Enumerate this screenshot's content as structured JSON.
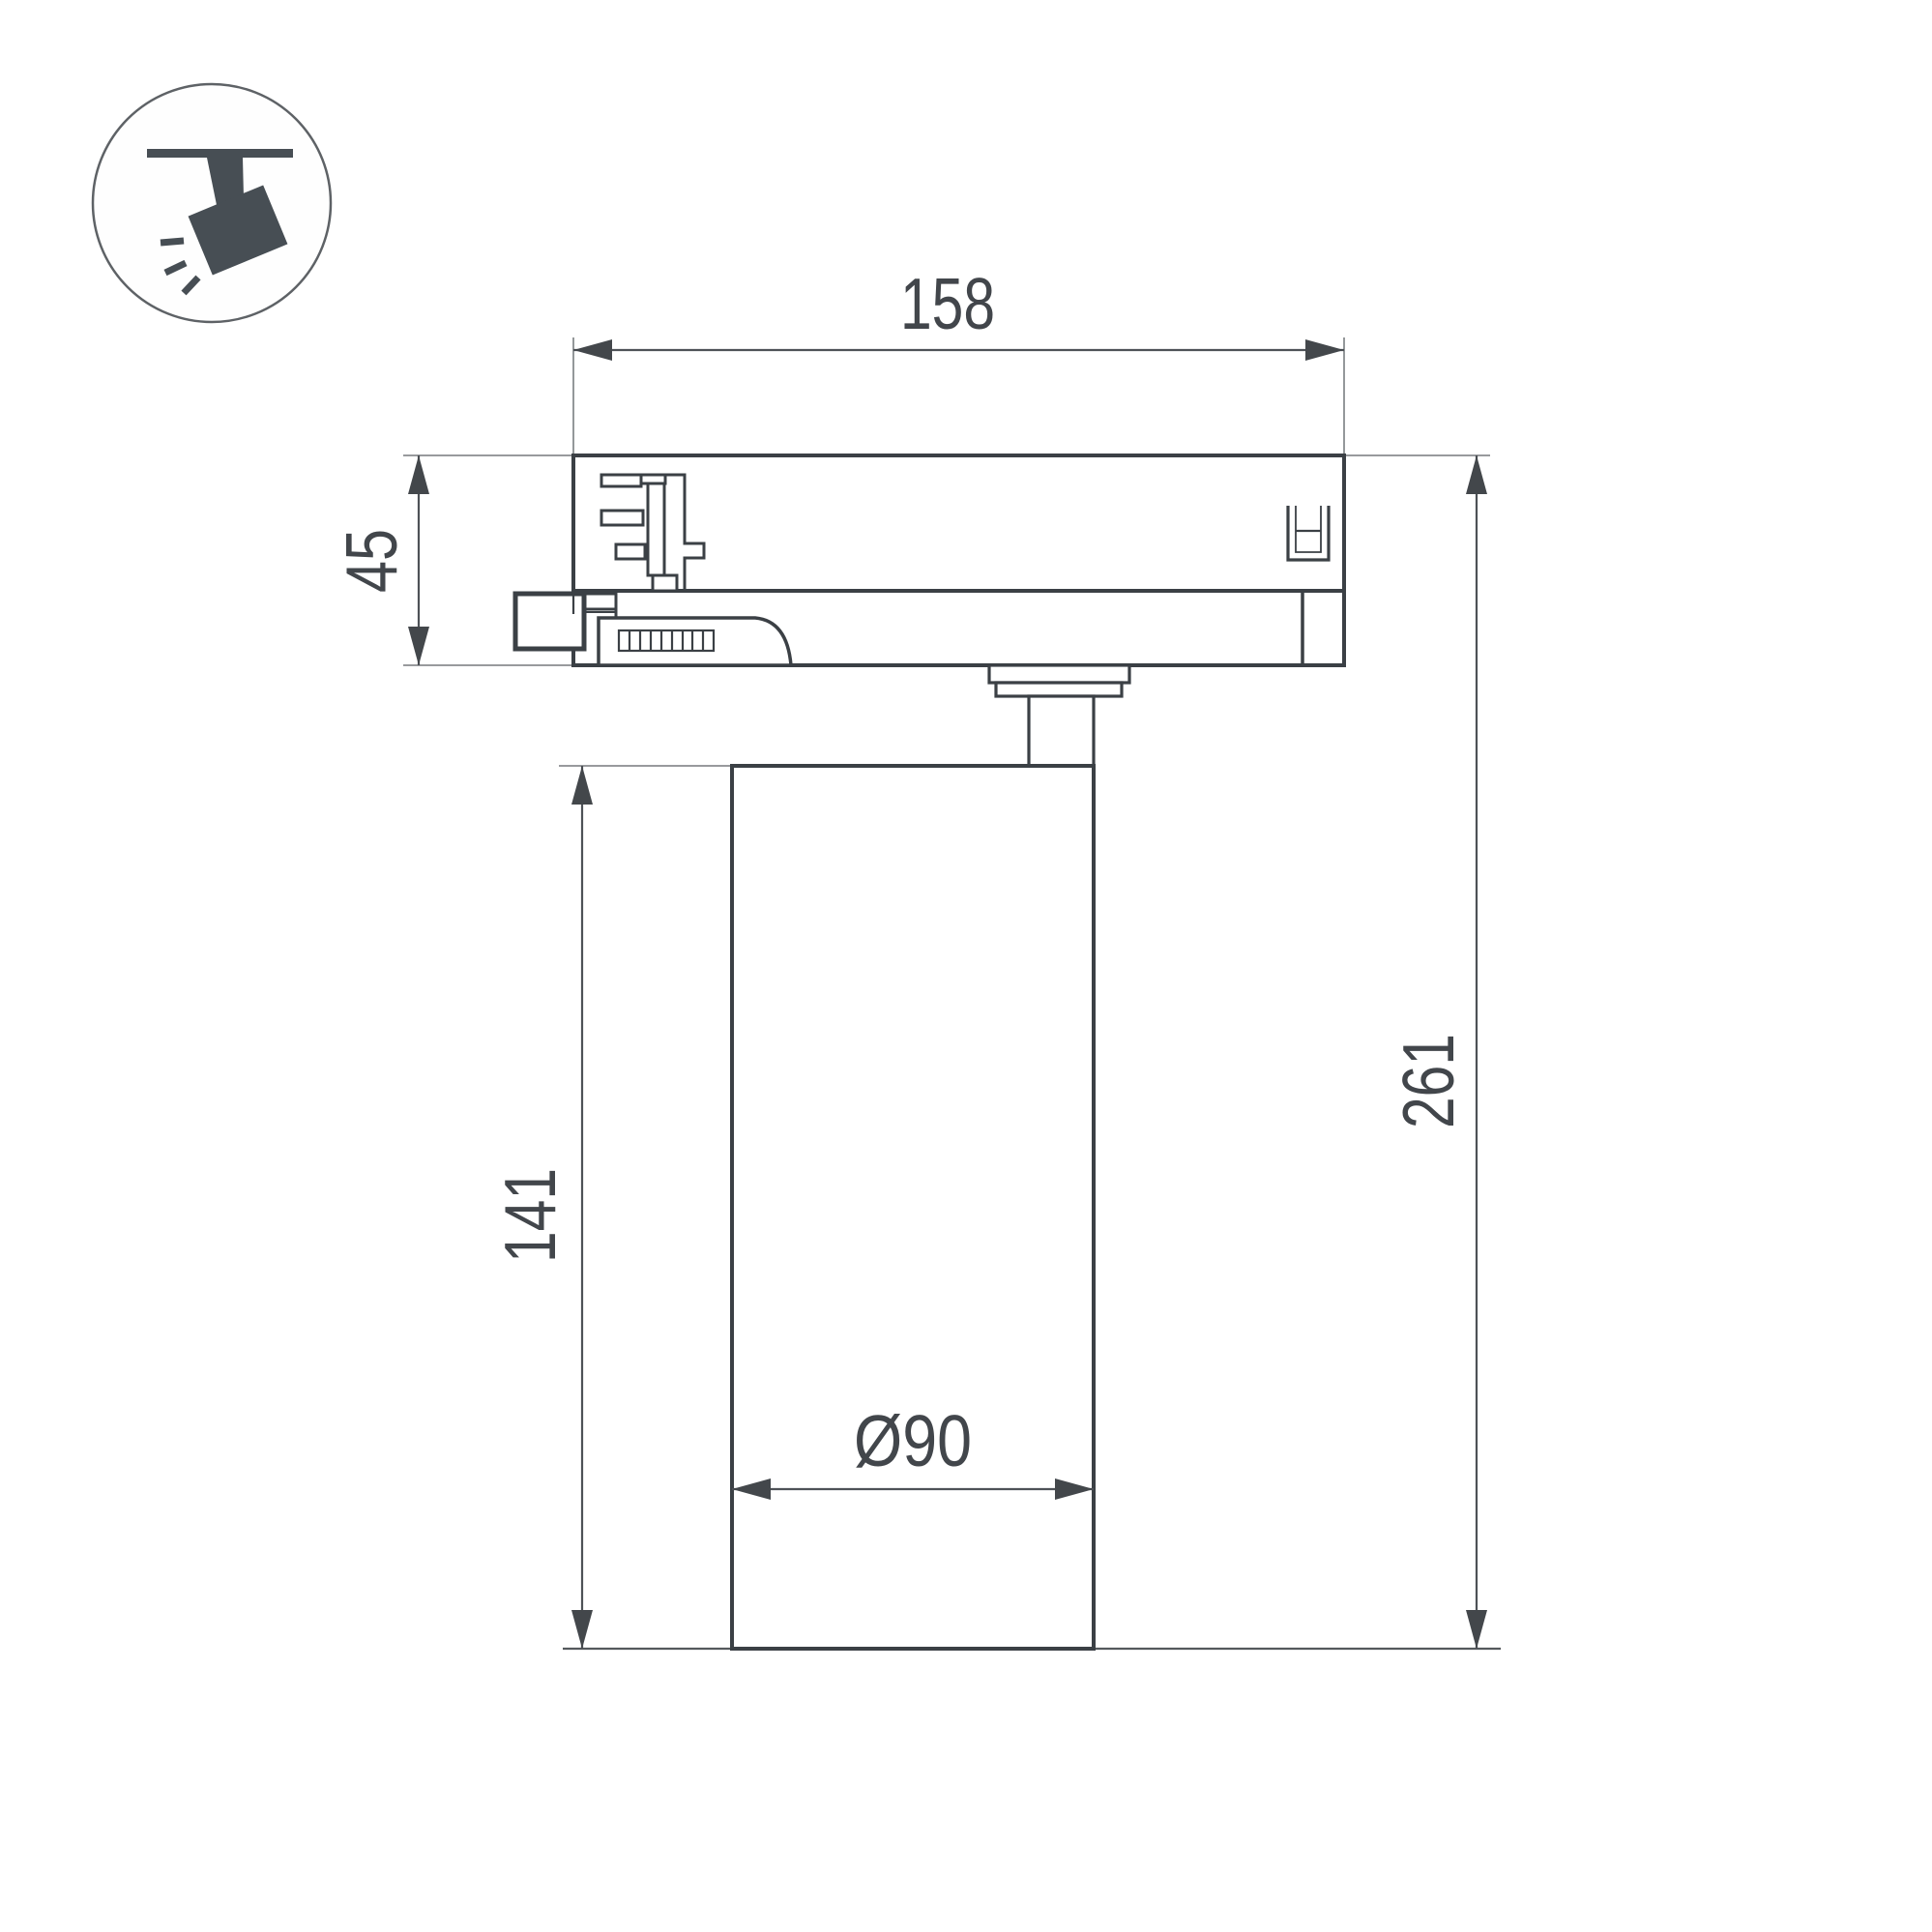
{
  "icon": {
    "name": "track-spotlight-pictogram",
    "color": "#474E54",
    "circle_stroke": "#5E6266"
  },
  "drawing": {
    "type": "technical-dimension-drawing",
    "subject": "track-mounted spotlight, side view",
    "colors": {
      "background": "#FFFFFF",
      "outline": "#3B4045",
      "dimension_line": "#4E5257",
      "extension_line": "#898C8F",
      "arrow": "#43474B",
      "label_text": "#42464B"
    },
    "dimensions": {
      "adapter_width": {
        "label": "158"
      },
      "adapter_height": {
        "label": "45"
      },
      "cylinder_height": {
        "label": "141"
      },
      "total_height": {
        "label": "261"
      },
      "cylinder_diameter": {
        "label": "Ø90"
      }
    }
  }
}
